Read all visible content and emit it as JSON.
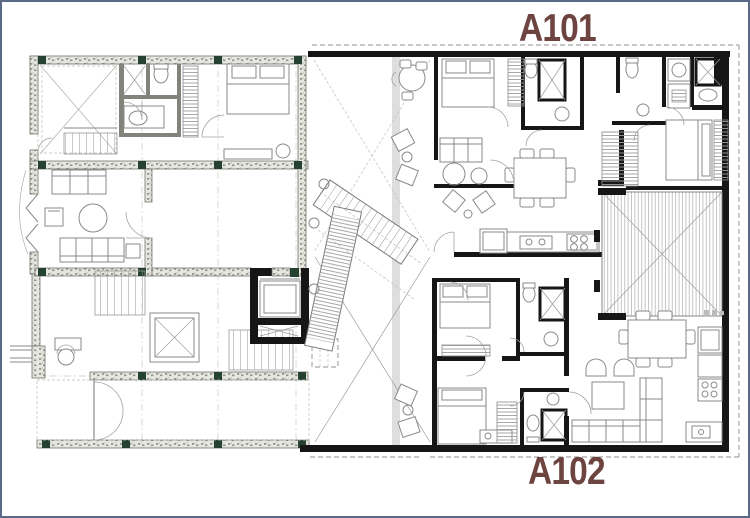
{
  "page": {
    "width": 750,
    "height": 518,
    "background": "#ffffff",
    "border_color": "#5a6a86"
  },
  "labels": {
    "a101": "A101",
    "a102": "A102"
  },
  "colors": {
    "label": "#6e4441",
    "wall_black": "#161616",
    "wall_hatch_fill": "#e7e7e2",
    "wall_hatch_dot": "#95958b",
    "wall_outline": "#73736b",
    "column_green": "#25412f",
    "furniture_line": "#8a8a8a",
    "construction_line": "#c9c9c4",
    "page_bg": "#ffffff",
    "page_border": "#5a6a86"
  },
  "drawing": {
    "type": "architectural floor plan",
    "units_labeled": [
      "A101",
      "A102"
    ]
  }
}
